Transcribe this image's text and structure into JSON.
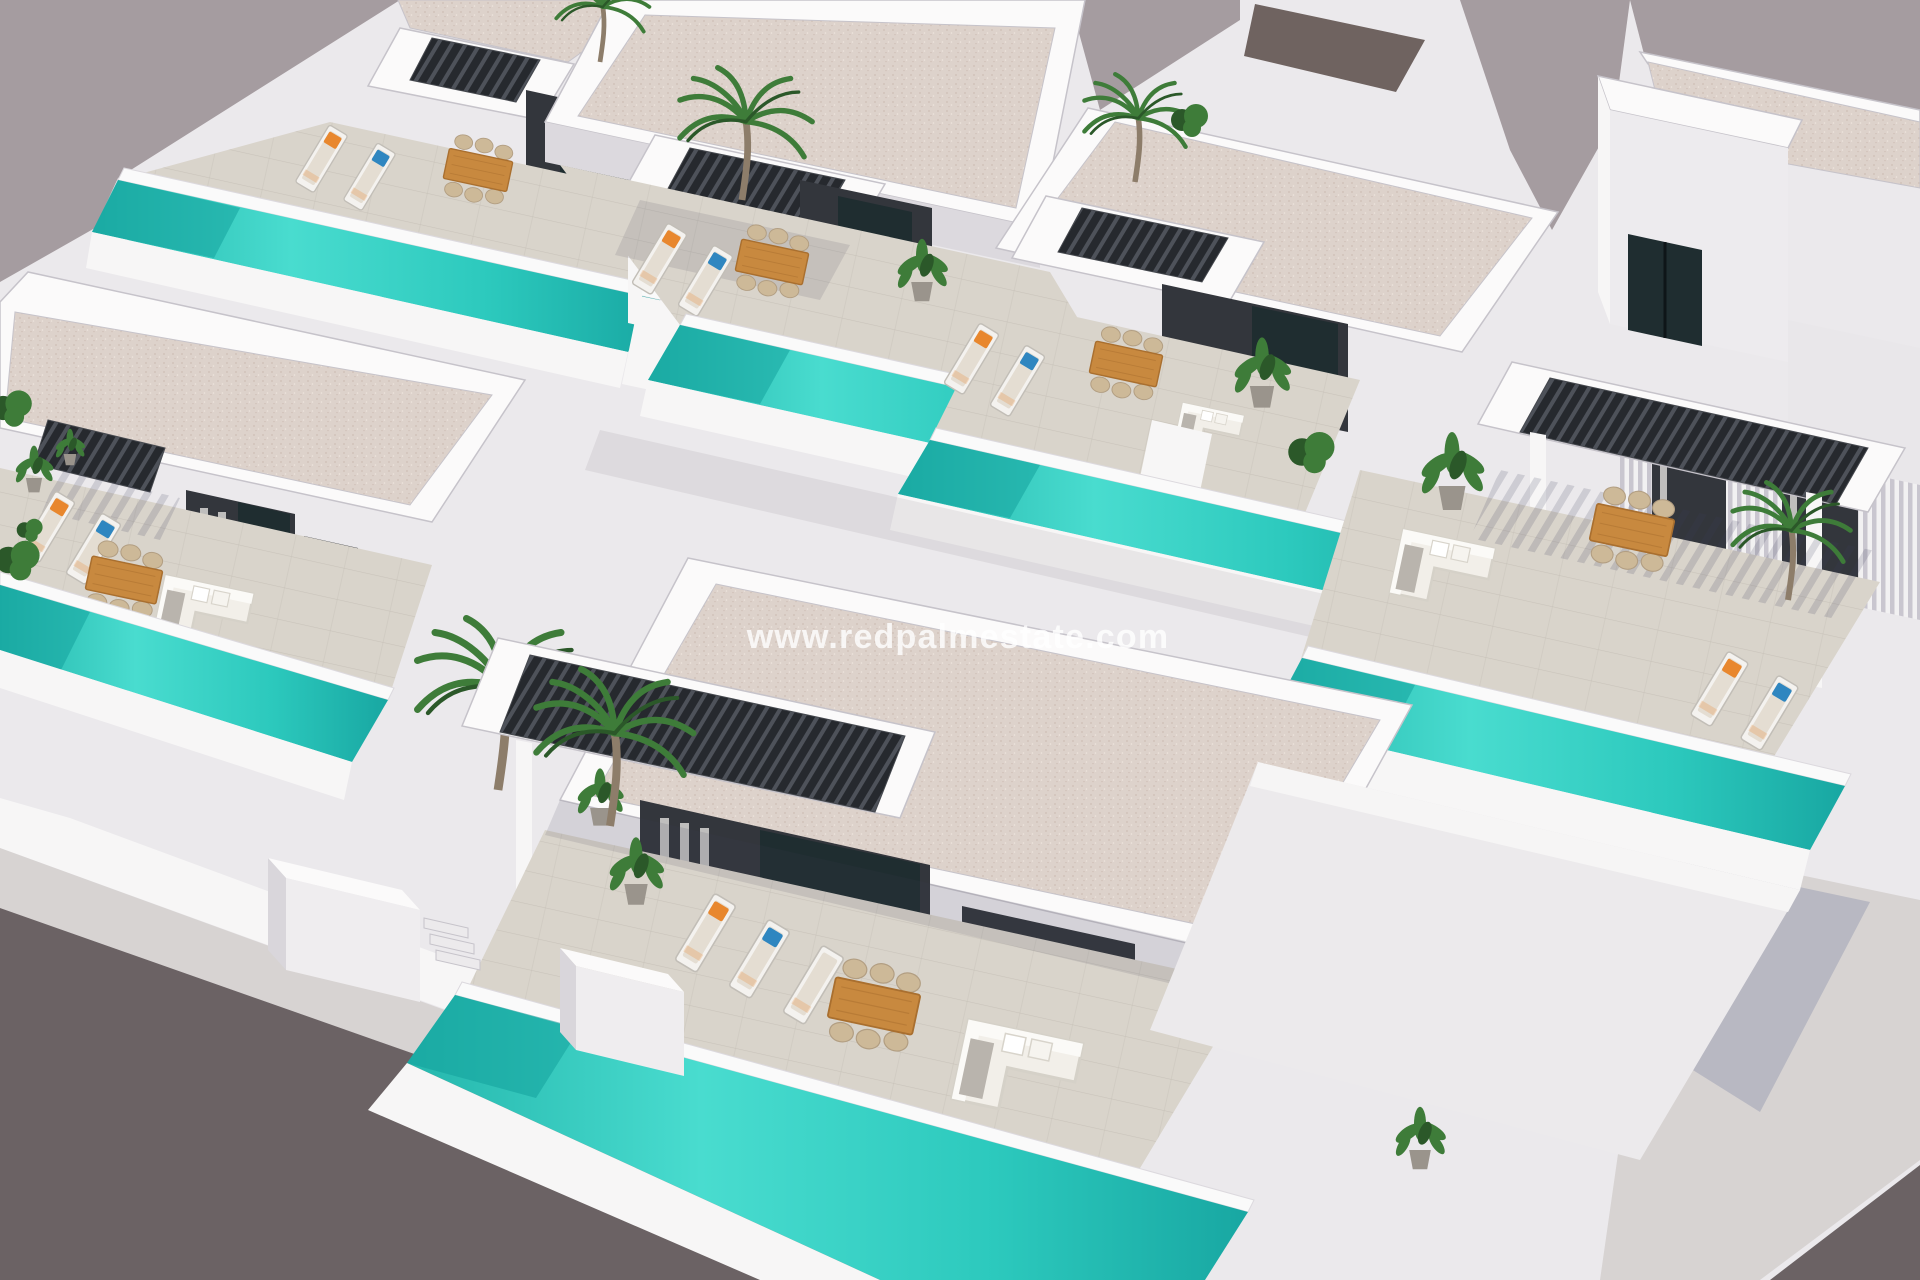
{
  "meta": {
    "type": "3d-architectural-render",
    "subject": "Aerial render of modern white villas with private turquoise lap pools, terraces, pergolas, sun loungers and palm trees"
  },
  "watermark": {
    "text": "www.redpalmestate.com"
  },
  "palette": {
    "backdrop": "#a59ca0",
    "street": "#6b6264",
    "sidewalk": "#d7d3d2",
    "white": "#f7f6f6",
    "wall": "#ebe9ec",
    "wall_mid": "#dcd9de",
    "wall_shadow": "#c6c3ca",
    "parapet": "#fbfafa",
    "roof": "#ddd2cb",
    "charcoal": "#33363c",
    "char_deep": "#22242a",
    "glass": "#1f2d30",
    "terrace": "#d9d4cb",
    "pool_1": "#63e8db",
    "pool_2": "#2cc9bd",
    "pool_3": "#0f9d9a",
    "coping": "#fafafa",
    "wood": "#c8893f",
    "wood_dark": "#a96f2f",
    "rattan": "#cdb998",
    "cushion": "#e4ddd2",
    "sofa": "#f2efe9",
    "throw": "#b9b4ad",
    "pillow_orange": "#e8872e",
    "pillow_blue": "#2f86c0",
    "green": "#3e7c39",
    "green_dark": "#2b5829",
    "trunk": "#8d7d6a",
    "pot": "#9a948c"
  }
}
